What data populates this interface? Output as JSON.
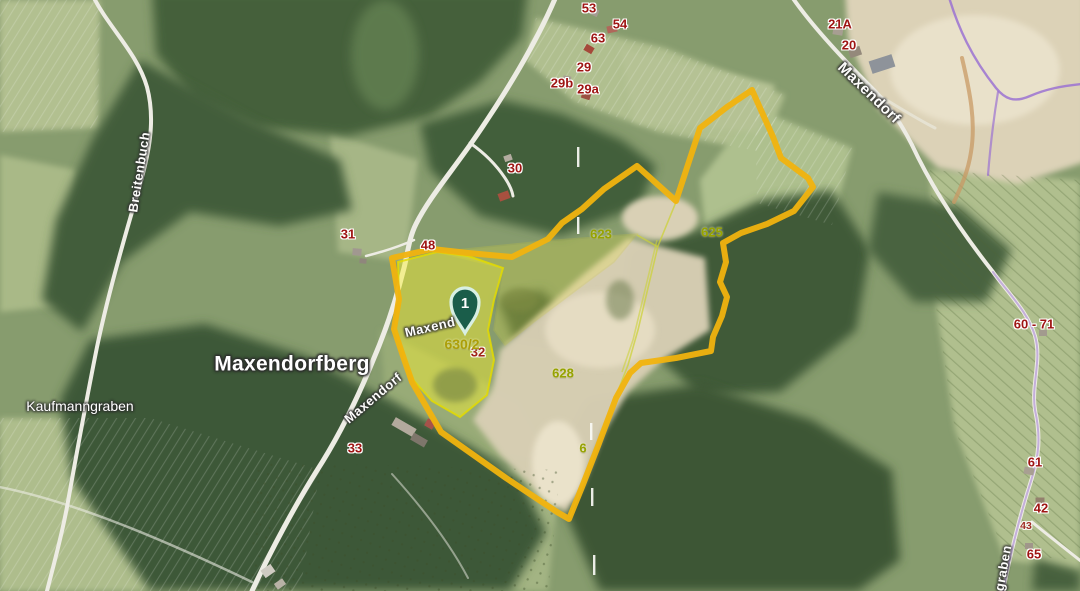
{
  "map": {
    "marker": {
      "label": "1"
    },
    "place_labels": [
      {
        "text": "Maxendorfberg"
      },
      {
        "text": "Kaufmanngraben"
      }
    ],
    "street_labels": [
      {
        "text": "Breitenbuch"
      },
      {
        "text": "Maxendorf"
      },
      {
        "text": "Maxend"
      },
      {
        "text": "Maxendorf"
      },
      {
        "text": "graben"
      }
    ],
    "house_numbers": [
      {
        "text": "53"
      },
      {
        "text": "54"
      },
      {
        "text": "63"
      },
      {
        "text": "29"
      },
      {
        "text": "29b"
      },
      {
        "text": "29a"
      },
      {
        "text": "30"
      },
      {
        "text": "31"
      },
      {
        "text": "48"
      },
      {
        "text": "33"
      },
      {
        "text": "32"
      },
      {
        "text": "21A"
      },
      {
        "text": "20"
      },
      {
        "text": "60 - 71"
      },
      {
        "text": "61"
      },
      {
        "text": "42"
      },
      {
        "text": "43"
      },
      {
        "text": "65"
      }
    ],
    "parcel_numbers": [
      {
        "text": "623"
      },
      {
        "text": "625"
      },
      {
        "text": "628"
      },
      {
        "text": "630/2"
      },
      {
        "text": "6"
      }
    ],
    "colors": {
      "boundary-yellow": "#f1b30e",
      "parcel-highlight": "#f9f22f",
      "pin-green": "#1a5d4a",
      "pin-ring": "#d8efe3",
      "house-number-red": "#9e1412",
      "parcel-number-olive": "#96a300",
      "road-white": "#edece4",
      "purple-line": "#9b72d2"
    }
  }
}
